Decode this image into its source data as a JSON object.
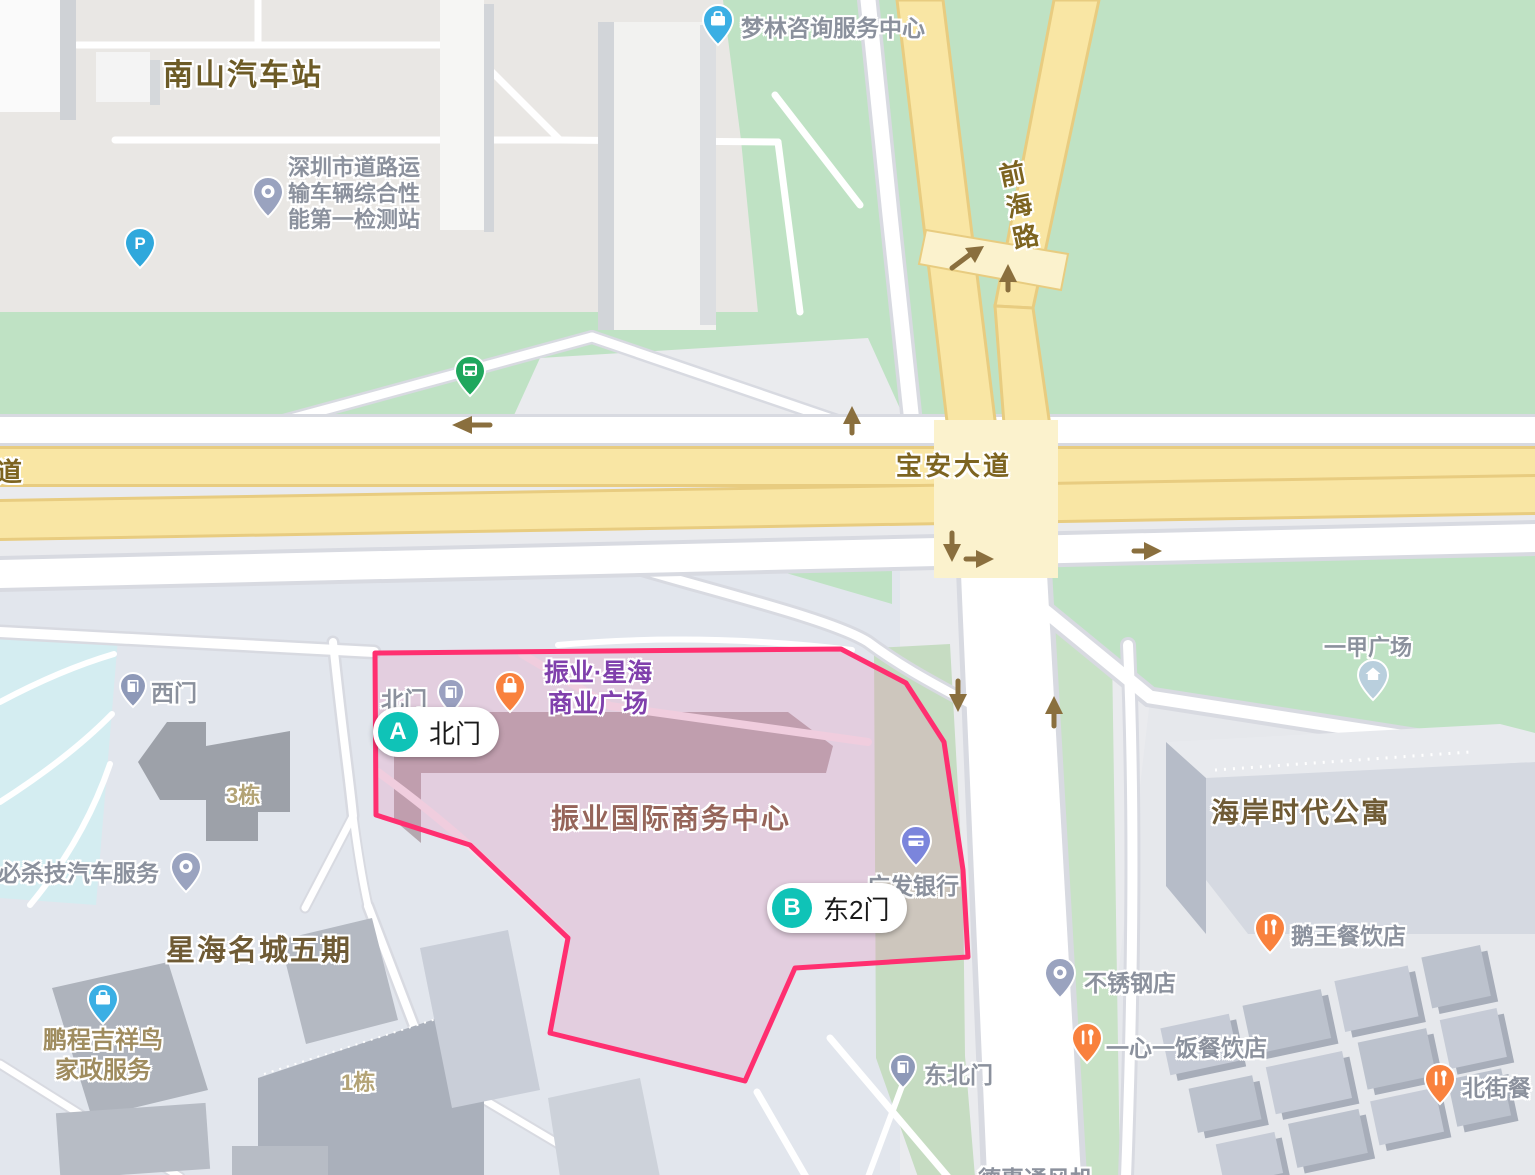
{
  "road_labels": {
    "baoan_avenue": "宝安大道",
    "qianhai_road": "前海路",
    "partial_road": "道"
  },
  "district_labels": {
    "nanshan_bus_station": "南山汽车站",
    "xinghai_mingcheng": "星海名城五期",
    "haian_shidai": "海岸时代公寓",
    "zhenye_intl_center": "振业国际商务中心",
    "building_3": "3栋",
    "building_1": "1栋"
  },
  "poi_labels": {
    "inspection_station": [
      "深圳市道路运",
      "输车辆综合性",
      "能第一检测站"
    ],
    "menglin": "梦林咨询服务中心",
    "zhenye_plaza": [
      "振业·星海",
      "商业广场"
    ],
    "north_gate_small": "北门",
    "guangfa_bank": "广发银行",
    "yijia_plaza": "一甲广场",
    "ewang_restaurant": "鹅王餐饮店",
    "stainless_shop": "不锈钢店",
    "yixin_restaurant": "一心一饭餐饮店",
    "beijie_restaurant": "北街餐",
    "northeast_gate": "东北门",
    "west_gate": "西门",
    "bishaji_auto": "必杀技汽车服务",
    "pengcheng": [
      "鹏程吉祥鸟",
      "家政服务"
    ],
    "dehui": "德惠通风机"
  },
  "gate_markers": {
    "a": {
      "letter": "A",
      "label": "北门"
    },
    "b": {
      "letter": "B",
      "label": "东2门"
    }
  },
  "icons": {
    "parking_letter": "P"
  },
  "colors": {
    "highlight_border": "#ff2f70",
    "marker_teal": "#0fc3b7",
    "road_yellow": "#f9e6a4",
    "map_green": "#c3e3c6",
    "poi_orange": "#f9813d",
    "poi_blue": "#3bafe4"
  }
}
